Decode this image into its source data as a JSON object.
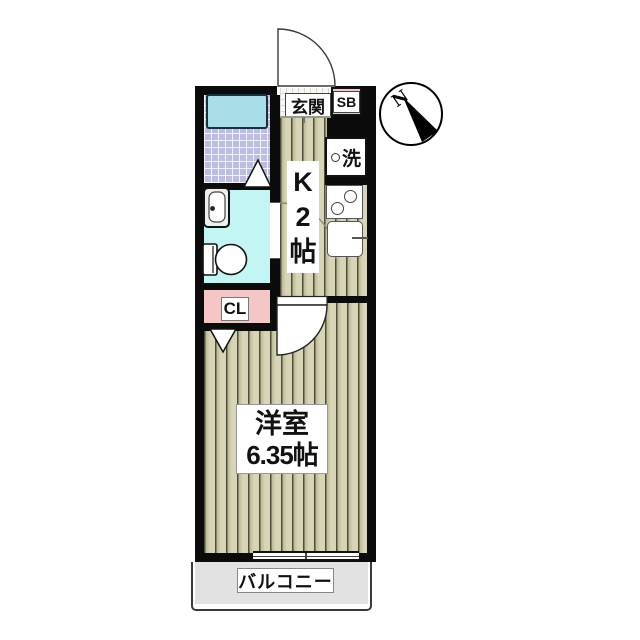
{
  "plan": {
    "entrance": {
      "label": "玄関",
      "shoe_box": "SB"
    },
    "kitchen": {
      "label_lines": [
        "K",
        "2",
        "帖"
      ],
      "washer": "洗"
    },
    "closet": {
      "label": "CL"
    },
    "room": {
      "name": "洋室",
      "size": "6.35帖"
    },
    "balcony": {
      "label": "バルコニー"
    },
    "compass": {
      "north": "N"
    }
  },
  "colors": {
    "wall": "#0b0b0b",
    "floor_base": "#d8d5b6",
    "floor_line": "#504e3a",
    "bath_tile": "#bdbde4",
    "bathtub": "#a7dee8",
    "washroom_bg": "#c2f5f3",
    "pink": "#f5c6c6",
    "balcony_gray": "#e2e2e2"
  }
}
